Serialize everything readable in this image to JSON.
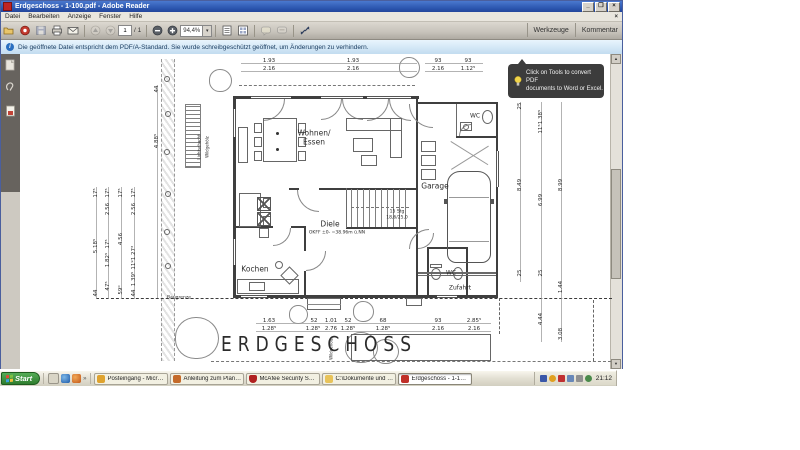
{
  "window": {
    "title": "Erdgeschoss - 1-100.pdf - Adobe Reader",
    "controls": {
      "minimize": "_",
      "restore": "❐",
      "close": "×",
      "menu_close": "×"
    }
  },
  "menubar": {
    "items": [
      "Datei",
      "Bearbeiten",
      "Anzeige",
      "Fenster",
      "Hilfe"
    ]
  },
  "toolbar": {
    "page_current": "1",
    "page_total": "/ 1",
    "zoom_value": "94,4%",
    "zoom_drop": "▾",
    "right_buttons": [
      "Werkzeuge",
      "Kommentar"
    ]
  },
  "infobar": {
    "icon": "i",
    "text": "Die geöffnete Datei entspricht dem PDF/A-Standard. Sie wurde schreibgeschützt geöffnet, um Änderungen zu verhindern."
  },
  "tooltip": {
    "line1": "Click on Tools to convert PDF",
    "line2": "documents to Word or Excel."
  },
  "scrollbar": {
    "up": "▲",
    "down": "▼"
  },
  "colors": {
    "titlebar_blue": "#2a54ad",
    "infobar_blue": "#c2dcf0",
    "start_green": "#2f7d2f",
    "adobe_red": "#c03028",
    "mcafee_red": "#b02020"
  },
  "plan": {
    "labels": [
      {
        "t": "Wohnen/",
        "x": 313,
        "y": 132,
        "c": "room"
      },
      {
        "t": "Essen",
        "x": 313,
        "y": 141,
        "c": "room"
      },
      {
        "t": "Kochen",
        "x": 254,
        "y": 268,
        "c": "room"
      },
      {
        "t": "Diele",
        "x": 329,
        "y": 223,
        "c": "room"
      },
      {
        "t": "OKFF ±0- =38.96m ü.NN",
        "x": 336,
        "y": 232,
        "c": "tiny"
      },
      {
        "t": "Garage",
        "x": 434,
        "y": 185,
        "c": "room"
      },
      {
        "t": "WC",
        "x": 474,
        "y": 115,
        "c": "room-sm"
      },
      {
        "t": "WC",
        "x": 450,
        "y": 272,
        "c": "room-sm"
      },
      {
        "t": "Zufahrt",
        "x": 459,
        "y": 287,
        "c": "room-sm"
      },
      {
        "t": "ERDGESCHOSS",
        "x": 318,
        "y": 344,
        "c": "big"
      },
      {
        "t": "Baugrenze",
        "x": 178,
        "y": 297,
        "c": "tiny"
      },
      {
        "t": "Lichtschacht",
        "x": 198,
        "y": 146,
        "c": "vtiny"
      },
      {
        "t": "Wildgehölz",
        "x": 206,
        "y": 146,
        "c": "vtiny"
      },
      {
        "t": "Wildgehölz",
        "x": 330,
        "y": 348,
        "c": "vtiny"
      },
      {
        "t": "15 Stg",
        "x": 396,
        "y": 211,
        "c": "tiny"
      },
      {
        "t": "18,6/25,0",
        "x": 396,
        "y": 217,
        "c": "tiny"
      }
    ],
    "dims": [
      {
        "t": "1.93",
        "x": 268,
        "y": 60
      },
      {
        "t": "2.16",
        "x": 268,
        "y": 68
      },
      {
        "t": "1.93",
        "x": 352,
        "y": 60
      },
      {
        "t": "2.16",
        "x": 352,
        "y": 68
      },
      {
        "t": "93",
        "x": 437,
        "y": 60
      },
      {
        "t": "2.16",
        "x": 437,
        "y": 68
      },
      {
        "t": "93",
        "x": 467,
        "y": 60
      },
      {
        "t": "1.12⁵",
        "x": 467,
        "y": 68
      },
      {
        "t": "17⁵",
        "x": 95,
        "y": 192,
        "v": 1
      },
      {
        "t": "5.18⁵",
        "x": 95,
        "y": 245,
        "v": 1
      },
      {
        "t": "44",
        "x": 95,
        "y": 292,
        "v": 1
      },
      {
        "t": "17⁵",
        "x": 107,
        "y": 192,
        "v": 1
      },
      {
        "t": "2.56",
        "x": 107,
        "y": 208,
        "v": 1
      },
      {
        "t": "17⁵",
        "x": 107,
        "y": 243,
        "v": 1
      },
      {
        "t": "1.82⁵",
        "x": 107,
        "y": 259,
        "v": 1
      },
      {
        "t": "47⁵",
        "x": 107,
        "y": 285,
        "v": 1
      },
      {
        "t": "17⁵",
        "x": 120,
        "y": 192,
        "v": 1
      },
      {
        "t": "4.56",
        "x": 120,
        "y": 238,
        "v": 1
      },
      {
        "t": "59⁰",
        "x": 120,
        "y": 289,
        "v": 1
      },
      {
        "t": "17⁵",
        "x": 133,
        "y": 192,
        "v": 1
      },
      {
        "t": "2.56",
        "x": 133,
        "y": 208,
        "v": 1
      },
      {
        "t": "1.27³",
        "x": 133,
        "y": 252,
        "v": 1
      },
      {
        "t": "11⁹",
        "x": 133,
        "y": 264,
        "v": 1
      },
      {
        "t": "1.39⁵",
        "x": 133,
        "y": 278,
        "v": 1
      },
      {
        "t": "44",
        "x": 133,
        "y": 292,
        "v": 1
      },
      {
        "t": "44",
        "x": 156,
        "y": 88,
        "v": 1
      },
      {
        "t": "4.88⁵",
        "x": 156,
        "y": 140,
        "v": 1
      },
      {
        "t": "25",
        "x": 519,
        "y": 105,
        "v": 1
      },
      {
        "t": "8.49",
        "x": 519,
        "y": 184,
        "v": 1
      },
      {
        "t": "25",
        "x": 519,
        "y": 272,
        "v": 1
      },
      {
        "t": "1.38⁵",
        "x": 540,
        "y": 116,
        "v": 1
      },
      {
        "t": "11⁵",
        "x": 540,
        "y": 128,
        "v": 1
      },
      {
        "t": "6.99",
        "x": 540,
        "y": 199,
        "v": 1
      },
      {
        "t": "25",
        "x": 540,
        "y": 272,
        "v": 1
      },
      {
        "t": "4.44",
        "x": 540,
        "y": 318,
        "v": 1
      },
      {
        "t": "8.99",
        "x": 560,
        "y": 184,
        "v": 1
      },
      {
        "t": "1.44",
        "x": 560,
        "y": 286,
        "v": 1
      },
      {
        "t": "3.08",
        "x": 560,
        "y": 333,
        "v": 1
      },
      {
        "t": "1.63",
        "x": 268,
        "y": 320
      },
      {
        "t": "1.28⁵",
        "x": 268,
        "y": 328
      },
      {
        "t": "52",
        "x": 313,
        "y": 320
      },
      {
        "t": "1.28⁵",
        "x": 312,
        "y": 328
      },
      {
        "t": "1.01",
        "x": 330,
        "y": 320
      },
      {
        "t": "2.76",
        "x": 330,
        "y": 328
      },
      {
        "t": "52",
        "x": 347,
        "y": 320
      },
      {
        "t": "1.28⁵",
        "x": 347,
        "y": 328
      },
      {
        "t": "68",
        "x": 382,
        "y": 320
      },
      {
        "t": "1.28⁵",
        "x": 382,
        "y": 328
      },
      {
        "t": "93",
        "x": 437,
        "y": 320
      },
      {
        "t": "2.16",
        "x": 437,
        "y": 328
      },
      {
        "t": "2.85⁵",
        "x": 473,
        "y": 320
      },
      {
        "t": "2.16",
        "x": 473,
        "y": 328
      }
    ]
  },
  "taskbar": {
    "start": "Start",
    "overflow": "»",
    "tasks": [
      {
        "label": "Posteingang - Microsoft ...",
        "icon": "outlook"
      },
      {
        "label": "Anleitung zum Planungs-...",
        "icon": "doc"
      },
      {
        "label": "McAfee Security Scan Plus",
        "icon": "mcafee"
      },
      {
        "label": "C:\\Dokumente und Einst...",
        "icon": "folder"
      },
      {
        "label": "Erdgeschoss - 1-100...",
        "icon": "adobe",
        "active": true
      }
    ],
    "clock": "21:12"
  }
}
